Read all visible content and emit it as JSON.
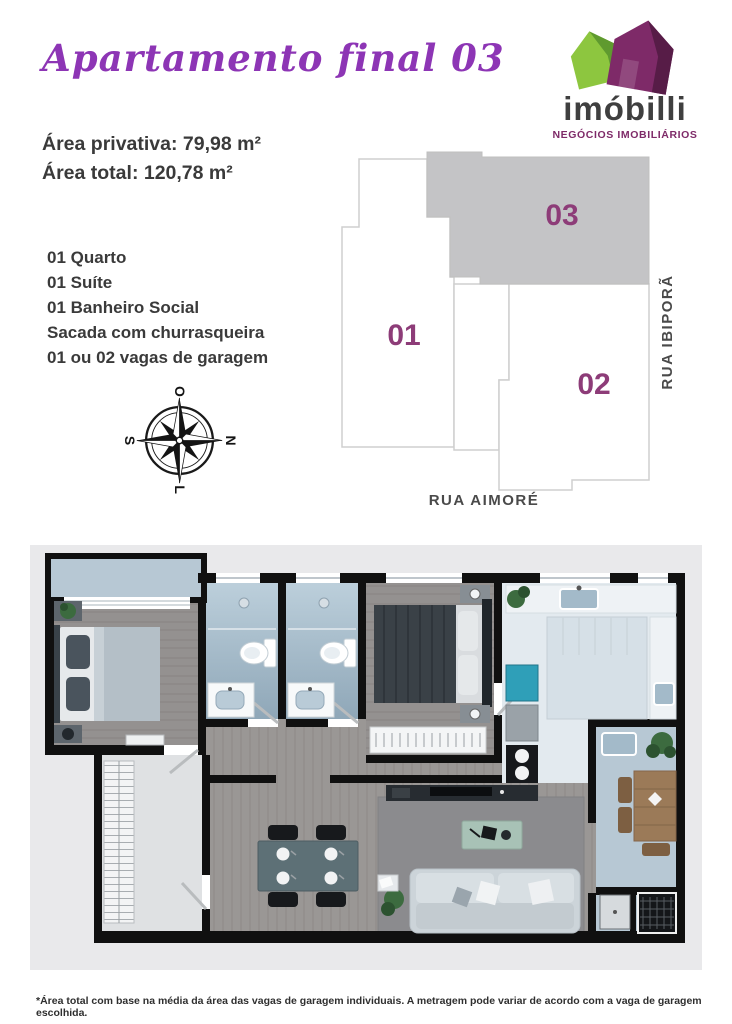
{
  "header": {
    "title": "Apartamento final 03"
  },
  "logo": {
    "name": "imóbilli",
    "tagline": "NEGÓCIOS IMOBILIÁRIOS"
  },
  "areas": {
    "private": "Área privativa: 79,98 m²",
    "total": "Área total: 120,78 m²"
  },
  "features": [
    "01 Quarto",
    "01 Suíte",
    "01 Banheiro Social",
    "Sacada com churrasqueira",
    "01 ou 02 vagas de garagem"
  ],
  "compass": {
    "north": "N",
    "east": "L",
    "south": "S",
    "west": "O"
  },
  "site_plan": {
    "units": [
      {
        "label": "01",
        "highlighted": false
      },
      {
        "label": "02",
        "highlighted": false
      },
      {
        "label": "03",
        "highlighted": true
      }
    ],
    "streets": {
      "right": "RUA IBIPORÃ",
      "bottom": "RUA AIMORÉ"
    }
  },
  "footer": {
    "disclaimer": "*Área total com base na média da área das vagas de garagem individuais. A metragem pode variar de acordo com a vaga de garagem escolhida."
  },
  "colors": {
    "title_purple": "#8d35b5",
    "brand_purple": "#7e2a68",
    "brand_green": "#8dc63f",
    "text_dark": "#3a3a3a",
    "unit_number": "#8d3c78",
    "unit_highlight_fill": "#c4c4c6",
    "plan_outline": "#cfcfcf",
    "street_label": "#4a4a4a",
    "floorplan_canvas": "#e9e9eb",
    "wall_black": "#101010"
  }
}
